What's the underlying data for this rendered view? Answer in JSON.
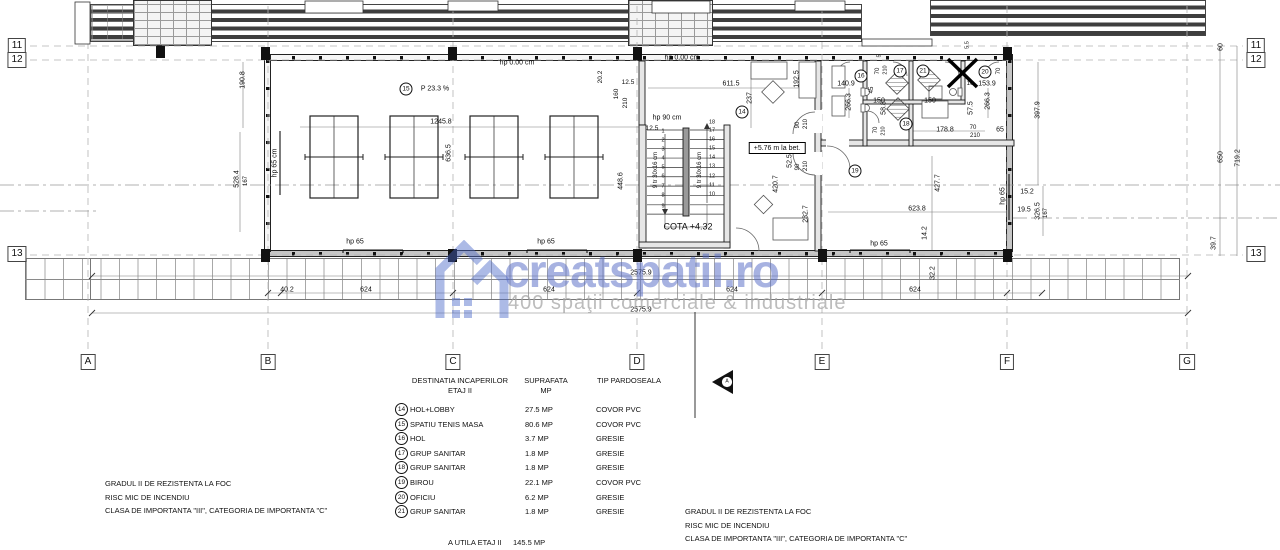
{
  "watermark": {
    "brand": "creatspatii.ro",
    "tagline": "400 spaţii comerciale & industriale",
    "brand_color": "#566cc6",
    "tagline_color": "#a5a5a5"
  },
  "grid": {
    "columns": [
      {
        "label": "A",
        "x": 88
      },
      {
        "label": "B",
        "x": 268
      },
      {
        "label": "C",
        "x": 453
      },
      {
        "label": "D",
        "x": 637
      },
      {
        "label": "E",
        "x": 822
      },
      {
        "label": "F",
        "x": 1007
      },
      {
        "label": "G",
        "x": 1187
      }
    ],
    "rows": [
      {
        "label": "11",
        "y": 46
      },
      {
        "label": "12",
        "y": 60
      },
      {
        "label": "13",
        "y": 254
      }
    ]
  },
  "rooms": [
    {
      "num": "14",
      "x": 742,
      "y": 112
    },
    {
      "num": "15",
      "x": 406,
      "y": 89
    },
    {
      "num": "16",
      "x": 861,
      "y": 76
    },
    {
      "num": "17",
      "x": 900,
      "y": 71
    },
    {
      "num": "18",
      "x": 906,
      "y": 124
    },
    {
      "num": "19",
      "x": 855,
      "y": 171
    },
    {
      "num": "20",
      "x": 985,
      "y": 72
    },
    {
      "num": "21",
      "x": 923,
      "y": 71
    }
  ],
  "section_marker": "A",
  "annotations": [
    {
      "t": "hp 0.00 cm",
      "x": 517,
      "y": 63,
      "r": 0
    },
    {
      "t": "hp 0.00 cm",
      "x": 682,
      "y": 58,
      "r": 0
    },
    {
      "t": "P 23.3 %",
      "x": 435,
      "y": 89,
      "r": 0
    },
    {
      "t": "1245.8",
      "x": 441,
      "y": 122,
      "r": 0
    },
    {
      "t": "190.8",
      "x": 243,
      "y": 80,
      "r": 90
    },
    {
      "t": "hp 65 cm",
      "x": 275,
      "y": 163,
      "r": 90
    },
    {
      "t": "528.4",
      "x": 237,
      "y": 179,
      "r": 90
    },
    {
      "t": "167",
      "x": 246,
      "y": 181,
      "r": 90,
      "s": 6
    },
    {
      "t": "636.5",
      "x": 449,
      "y": 153,
      "r": 90
    },
    {
      "t": "448.6",
      "x": 621,
      "y": 181,
      "r": 90
    },
    {
      "t": "20.2",
      "x": 601,
      "y": 77,
      "r": 90,
      "s": 6.5
    },
    {
      "t": "12.5",
      "x": 628,
      "y": 83,
      "r": 0,
      "s": 6.5
    },
    {
      "t": "160",
      "x": 617,
      "y": 94,
      "r": 90,
      "s": 6.5
    },
    {
      "t": "210",
      "x": 626,
      "y": 103,
      "r": 90,
      "s": 6.5
    },
    {
      "t": "hp 90 cm",
      "x": 667,
      "y": 118,
      "r": 0
    },
    {
      "t": "12.5",
      "x": 652,
      "y": 129,
      "r": 0,
      "s": 6.5
    },
    {
      "t": "9 tr 30x16 cm",
      "x": 656,
      "y": 170,
      "r": 90,
      "s": 6
    },
    {
      "t": "9 tr 30x16 cm",
      "x": 700,
      "y": 170,
      "r": 90,
      "s": 6
    },
    {
      "t": "COTA +4.32",
      "x": 688,
      "y": 227,
      "r": 0,
      "s": 9
    },
    {
      "t": "+5.76 m la bet.",
      "x": 777,
      "y": 148,
      "r": 0,
      "box": 1
    },
    {
      "t": "611.5",
      "x": 731,
      "y": 84,
      "r": 0
    },
    {
      "t": "237",
      "x": 750,
      "y": 98,
      "r": 90
    },
    {
      "t": "192.5",
      "x": 797,
      "y": 79,
      "r": 90
    },
    {
      "t": "140.9",
      "x": 846,
      "y": 84,
      "r": 0
    },
    {
      "t": "266.3",
      "x": 849,
      "y": 102,
      "r": 90
    },
    {
      "t": "150",
      "x": 879,
      "y": 101,
      "r": 0
    },
    {
      "t": "150",
      "x": 930,
      "y": 101,
      "r": 0
    },
    {
      "t": "70",
      "x": 878,
      "y": 71,
      "r": 90,
      "s": 6
    },
    {
      "t": "210",
      "x": 886,
      "y": 70,
      "r": 90,
      "s": 5.5
    },
    {
      "t": "45",
      "x": 872,
      "y": 90,
      "r": 90,
      "s": 6
    },
    {
      "t": "58.8",
      "x": 884,
      "y": 108,
      "r": 90
    },
    {
      "t": "70",
      "x": 876,
      "y": 130,
      "r": 90,
      "s": 6
    },
    {
      "t": "210",
      "x": 884,
      "y": 131,
      "r": 90,
      "s": 5.5
    },
    {
      "t": "5",
      "x": 880,
      "y": 56,
      "r": 90,
      "s": 5.5
    },
    {
      "t": "5.5",
      "x": 968,
      "y": 45,
      "r": 90,
      "s": 5.5
    },
    {
      "t": "70",
      "x": 999,
      "y": 71,
      "r": 90,
      "s": 6
    },
    {
      "t": "10",
      "x": 970,
      "y": 84,
      "r": 0,
      "s": 6
    },
    {
      "t": "153.9",
      "x": 987,
      "y": 84,
      "r": 0
    },
    {
      "t": "266.3",
      "x": 988,
      "y": 101,
      "r": 90
    },
    {
      "t": "57.5",
      "x": 971,
      "y": 108,
      "r": 90
    },
    {
      "t": "178.8",
      "x": 945,
      "y": 130,
      "r": 0
    },
    {
      "t": "70",
      "x": 973,
      "y": 128,
      "r": 0,
      "s": 6
    },
    {
      "t": "210",
      "x": 975,
      "y": 136,
      "r": 0,
      "s": 6
    },
    {
      "t": "65",
      "x": 1000,
      "y": 130,
      "r": 0
    },
    {
      "t": "90",
      "x": 798,
      "y": 125,
      "r": 90,
      "s": 6
    },
    {
      "t": "210",
      "x": 806,
      "y": 124,
      "r": 90,
      "s": 6
    },
    {
      "t": "90",
      "x": 798,
      "y": 167,
      "r": 90,
      "s": 6
    },
    {
      "t": "210",
      "x": 806,
      "y": 166,
      "r": 90,
      "s": 6
    },
    {
      "t": "52.5",
      "x": 790,
      "y": 161,
      "r": 90
    },
    {
      "t": "420.7",
      "x": 776,
      "y": 184,
      "r": 90
    },
    {
      "t": "232.7",
      "x": 806,
      "y": 214,
      "r": 90
    },
    {
      "t": "427.7",
      "x": 938,
      "y": 183,
      "r": 90
    },
    {
      "t": "623.8",
      "x": 917,
      "y": 209,
      "r": 0
    },
    {
      "t": "14.2",
      "x": 925,
      "y": 233,
      "r": 90
    },
    {
      "t": "hp 65",
      "x": 879,
      "y": 244,
      "r": 0
    },
    {
      "t": "hp 65",
      "x": 1003,
      "y": 196,
      "r": 90
    },
    {
      "t": "15.2",
      "x": 1027,
      "y": 192,
      "r": 0
    },
    {
      "t": "19.5",
      "x": 1024,
      "y": 210,
      "r": 0
    },
    {
      "t": "326.5",
      "x": 1038,
      "y": 211,
      "r": 90
    },
    {
      "t": "167",
      "x": 1046,
      "y": 213,
      "r": 90,
      "s": 6
    },
    {
      "t": "397.9",
      "x": 1038,
      "y": 110,
      "r": 90
    },
    {
      "t": "60",
      "x": 1221,
      "y": 47,
      "r": 90
    },
    {
      "t": "650",
      "x": 1221,
      "y": 157,
      "r": 90
    },
    {
      "t": "719.2",
      "x": 1238,
      "y": 158,
      "r": 90
    },
    {
      "t": "39.7",
      "x": 1214,
      "y": 243,
      "r": 90
    },
    {
      "t": "hp 65",
      "x": 355,
      "y": 242,
      "r": 0
    },
    {
      "t": "hp 65",
      "x": 546,
      "y": 242,
      "r": 0
    },
    {
      "t": "40.2",
      "x": 287,
      "y": 290,
      "r": 0
    },
    {
      "t": "624",
      "x": 366,
      "y": 290,
      "r": 0
    },
    {
      "t": "624",
      "x": 549,
      "y": 290,
      "r": 0
    },
    {
      "t": "624",
      "x": 732,
      "y": 290,
      "r": 0
    },
    {
      "t": "624",
      "x": 915,
      "y": 290,
      "r": 0
    },
    {
      "t": "2575.9",
      "x": 641,
      "y": 273,
      "r": 0
    },
    {
      "t": "2575.9",
      "x": 641,
      "y": 310,
      "r": 0
    },
    {
      "t": "32.2",
      "x": 933,
      "y": 273,
      "r": 90
    },
    {
      "t": "1",
      "x": 663,
      "y": 132,
      "r": 0,
      "s": 5.5
    },
    {
      "t": "2",
      "x": 663,
      "y": 141,
      "r": 0,
      "s": 5.5
    },
    {
      "t": "3",
      "x": 663,
      "y": 150,
      "r": 0,
      "s": 5.5
    },
    {
      "t": "4",
      "x": 663,
      "y": 159,
      "r": 0,
      "s": 5.5
    },
    {
      "t": "5",
      "x": 663,
      "y": 168,
      "r": 0,
      "s": 5.5
    },
    {
      "t": "6",
      "x": 663,
      "y": 177,
      "r": 0,
      "s": 5.5
    },
    {
      "t": "7",
      "x": 663,
      "y": 187,
      "r": 0,
      "s": 5.5
    },
    {
      "t": "8",
      "x": 663,
      "y": 196,
      "r": 0,
      "s": 5.5
    },
    {
      "t": "9",
      "x": 663,
      "y": 207,
      "r": 0,
      "s": 5.5
    },
    {
      "t": "18",
      "x": 712,
      "y": 123,
      "r": 0,
      "s": 5.5
    },
    {
      "t": "17",
      "x": 712,
      "y": 131,
      "r": 0,
      "s": 5.5
    },
    {
      "t": "16",
      "x": 712,
      "y": 140,
      "r": 0,
      "s": 5.5
    },
    {
      "t": "15",
      "x": 712,
      "y": 149,
      "r": 0,
      "s": 5.5
    },
    {
      "t": "14",
      "x": 712,
      "y": 158,
      "r": 0,
      "s": 5.5
    },
    {
      "t": "13",
      "x": 712,
      "y": 167,
      "r": 0,
      "s": 5.5
    },
    {
      "t": "12",
      "x": 712,
      "y": 177,
      "r": 0,
      "s": 5.5
    },
    {
      "t": "11",
      "x": 712,
      "y": 186,
      "r": 0,
      "s": 5.5
    },
    {
      "t": "10",
      "x": 712,
      "y": 195,
      "r": 0,
      "s": 5.5
    },
    {
      "t": "A",
      "x": 727,
      "y": 382,
      "r": 0,
      "s": 5
    }
  ],
  "legend": {
    "header": {
      "c1a": "DESTINATIA INCAPERILOR",
      "c1b": "ETAJ II",
      "c2a": "SUPRAFATA",
      "c2b": "MP",
      "c3": "TIP PARDOSEALA"
    },
    "rows": [
      {
        "num": "14",
        "name": "HOL+LOBBY",
        "area": "27.5 MP",
        "floor": "COVOR PVC"
      },
      {
        "num": "15",
        "name": "SPATIU TENIS MASA",
        "area": "80.6 MP",
        "floor": "COVOR PVC"
      },
      {
        "num": "16",
        "name": "HOL",
        "area": "3.7 MP",
        "floor": "GRESIE"
      },
      {
        "num": "17",
        "name": "GRUP SANITAR",
        "area": "1.8 MP",
        "floor": "GRESIE"
      },
      {
        "num": "18",
        "name": "GRUP SANITAR",
        "area": "1.8 MP",
        "floor": "GRESIE"
      },
      {
        "num": "19",
        "name": "BIROU",
        "area": "22.1 MP",
        "floor": "COVOR PVC"
      },
      {
        "num": "20",
        "name": "OFICIU",
        "area": "6.2 MP",
        "floor": "GRESIE"
      },
      {
        "num": "21",
        "name": "GRUP SANITAR",
        "area": "1.8 MP",
        "floor": "GRESIE"
      }
    ],
    "footer": {
      "label": "A UTILA ETAJ II",
      "value": "145.5 MP"
    }
  },
  "notes": [
    "GRADUL II DE REZISTENTA LA FOC",
    "RISC MIC DE INCENDIU",
    "CLASA DE IMPORTANTA \"III\", CATEGORIA DE IMPORTANTA \"C\""
  ]
}
